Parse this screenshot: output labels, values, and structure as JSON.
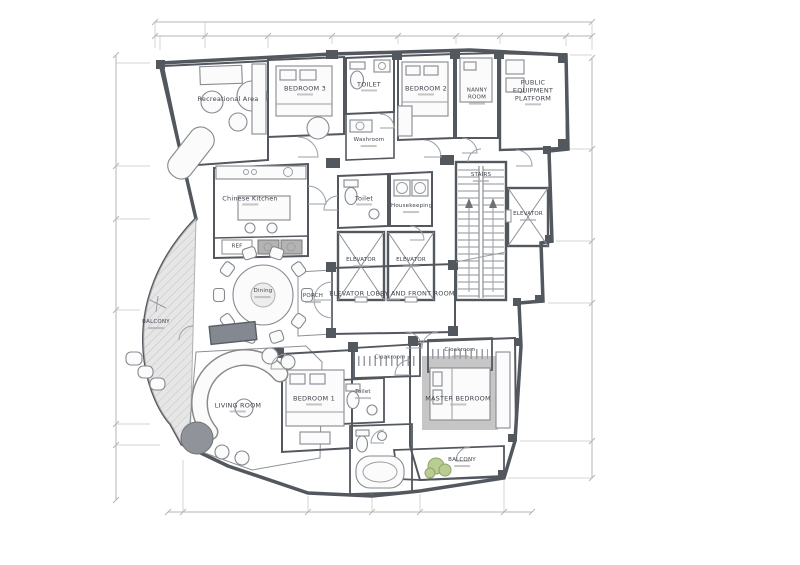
{
  "drawing": {
    "kind": "residential floor plan"
  },
  "colors": {
    "wall": "#53575e",
    "floor": "#d8d8d8",
    "room": "#f6f6f6",
    "label": "#3f434c",
    "plant": "#b9cd92",
    "paper": "#ffffff"
  },
  "rooms": {
    "recreational_area": "Recreational Area",
    "bedroom3": "BEDROOM 3",
    "toilet_top": "TOILET",
    "washroom": "Washroom",
    "bedroom2": "BEDROOM 2",
    "nanny_room": "NANNY ROOM",
    "public_equipment_platform": "PUBLIC EQUIPMENT PLATFORM",
    "chinese_kitchen": "Chinese Kitchen",
    "ref": "REF",
    "toilet_mid": "Toilet",
    "housekeeping": "Housekeeping",
    "elevator_a": "ELEVATOR",
    "elevator_b": "ELEVATOR",
    "elevator_right": "ELEVATOR",
    "stairs": "STAIRS",
    "elevator_lobby": "ELEVATOR LOBBY AND FRONT ROOM",
    "porch": "PORCH",
    "dining": "Dining",
    "balcony_left": "BALCONY",
    "living_room": "LIVING ROOM",
    "bedroom1": "BEDROOM 1",
    "toilet_bedroom1": "Toilet",
    "cloakroom_bedroom1": "Cloakroom",
    "master_bedroom": "MASTER BEDROOM",
    "cloakroom_master": "Cloakroom",
    "balcony_right": "BALCONY"
  }
}
